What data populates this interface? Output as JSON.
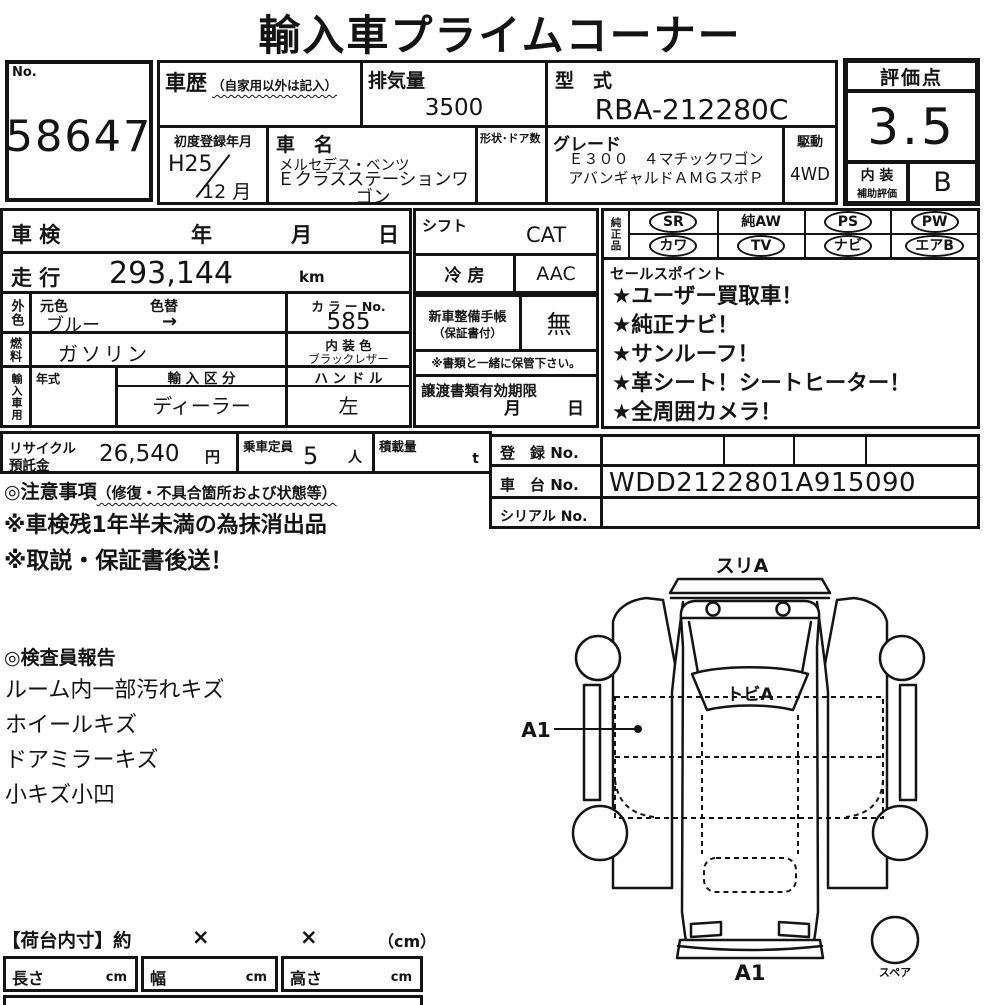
{
  "colors": {
    "ink": "#141414",
    "paper": "#ffffff"
  },
  "title": "輸入車プライムコーナー",
  "no_box": {
    "label": "No.",
    "value": "58647"
  },
  "history": {
    "label": "車歴",
    "note": "（自家用以外は記入）"
  },
  "displacement": {
    "label": "排気量",
    "value": "3500"
  },
  "model_code": {
    "label": "型　式",
    "value": "RBA-212280C"
  },
  "first_registration": {
    "label": "初度登録年月",
    "year": "H25",
    "month": "12 月"
  },
  "car_name": {
    "label": "車　名",
    "maker": "メルセデス・ベンツ",
    "name": "Ｅクラスステーションワゴン"
  },
  "body_doors": {
    "label": "形状･ドア数"
  },
  "grade": {
    "label": "グレード",
    "value": "Ｅ３００　４マチックワゴンアバンギャルドＡＭＧスポＰ"
  },
  "drive": {
    "label": "駆動",
    "value": "4WD"
  },
  "rating": {
    "label": "評価点",
    "score": "3.5",
    "interior_label_top": "内 装",
    "interior_label_bottom": "補助評価",
    "interior_grade": "B"
  },
  "inspection": {
    "label": "車 検",
    "year": "年",
    "month": "月",
    "day": "日"
  },
  "mileage": {
    "label": "走 行",
    "value": "293,144",
    "unit": "km"
  },
  "exterior": {
    "label": "外色",
    "original_label": "元色",
    "repaint_label": "色替",
    "original_value": "ブルー",
    "repaint_value": "→"
  },
  "color_no": {
    "label": "カ ラ ー No.",
    "value": "585"
  },
  "fuel": {
    "label": "燃料",
    "value": "ガソリン"
  },
  "interior_color": {
    "label": "内 装 色",
    "value": "ブラックレザー"
  },
  "import_info": {
    "label": "輸入車用",
    "year_label": "年式",
    "division_label": "輸 入 区 分",
    "division_value": "ディーラー",
    "handle_label": "ハ ン ド ル",
    "handle_value": "左"
  },
  "shift": {
    "label": "シフト",
    "value": "CAT"
  },
  "aircon": {
    "label": "冷 房",
    "value": "AAC"
  },
  "service_book": {
    "label_line1": "新車整備手帳",
    "label_line2": "（保証書付）",
    "value": "無",
    "note": "※書類と一緒に保管下さい。"
  },
  "transfer_docs": {
    "label": "譲渡書類有効期限",
    "month": "月",
    "day": "日"
  },
  "genuine_parts": {
    "label": "純正品",
    "items": [
      {
        "label": "SR",
        "circled": true
      },
      {
        "label": "純AW",
        "circled": false
      },
      {
        "label": "PS",
        "circled": true
      },
      {
        "label": "PW",
        "circled": true
      },
      {
        "label": "カワ",
        "circled": true
      },
      {
        "label": "TV",
        "circled": true
      },
      {
        "label": "ナビ",
        "circled": true
      },
      {
        "label": "エアB",
        "circled": true
      }
    ]
  },
  "sales_points": {
    "label": "セールスポイント",
    "items": [
      "★ユーザー買取車！",
      "★純正ナビ！",
      "★サンルーフ！",
      "★革シート！シートヒーター！",
      "★全周囲カメラ！"
    ]
  },
  "recycle": {
    "label_line1": "リサイクル",
    "label_line2": "預託金",
    "value": "26,540",
    "unit": "円"
  },
  "capacity": {
    "label": "乗車定員",
    "value": "5",
    "unit": "人"
  },
  "load": {
    "label": "積載量",
    "unit": "t"
  },
  "registration": {
    "reg_label": "登　録 No.",
    "chassis_label": "車　台 No.",
    "chassis_value": "WDD2122801A915090",
    "serial_label": "シリアル No."
  },
  "cautions": {
    "heading": "◎注意事項",
    "heading_note": "（修復・不具合箇所および状態等）",
    "lines": [
      "※車検残1年半未満の為抹消出品",
      "※取説・保証書後送！"
    ]
  },
  "inspector_report": {
    "heading": "◎検査員報告",
    "lines": [
      "ルーム内一部汚れキズ",
      "ホイールキズ",
      "ドアミラーキズ",
      "小キズ小凹"
    ]
  },
  "diagram": {
    "top_label": "スリA",
    "windshield_label": "トビA",
    "left_marker": "A1",
    "bottom_label": "A1",
    "spare_label": "スペア"
  },
  "cargo": {
    "heading": "【荷台内寸】約",
    "times1": "×",
    "times2": "×",
    "unit_note": "（cm）",
    "length_label": "長さ",
    "width_label": "幅",
    "height_label": "高さ",
    "unit": "cm"
  }
}
